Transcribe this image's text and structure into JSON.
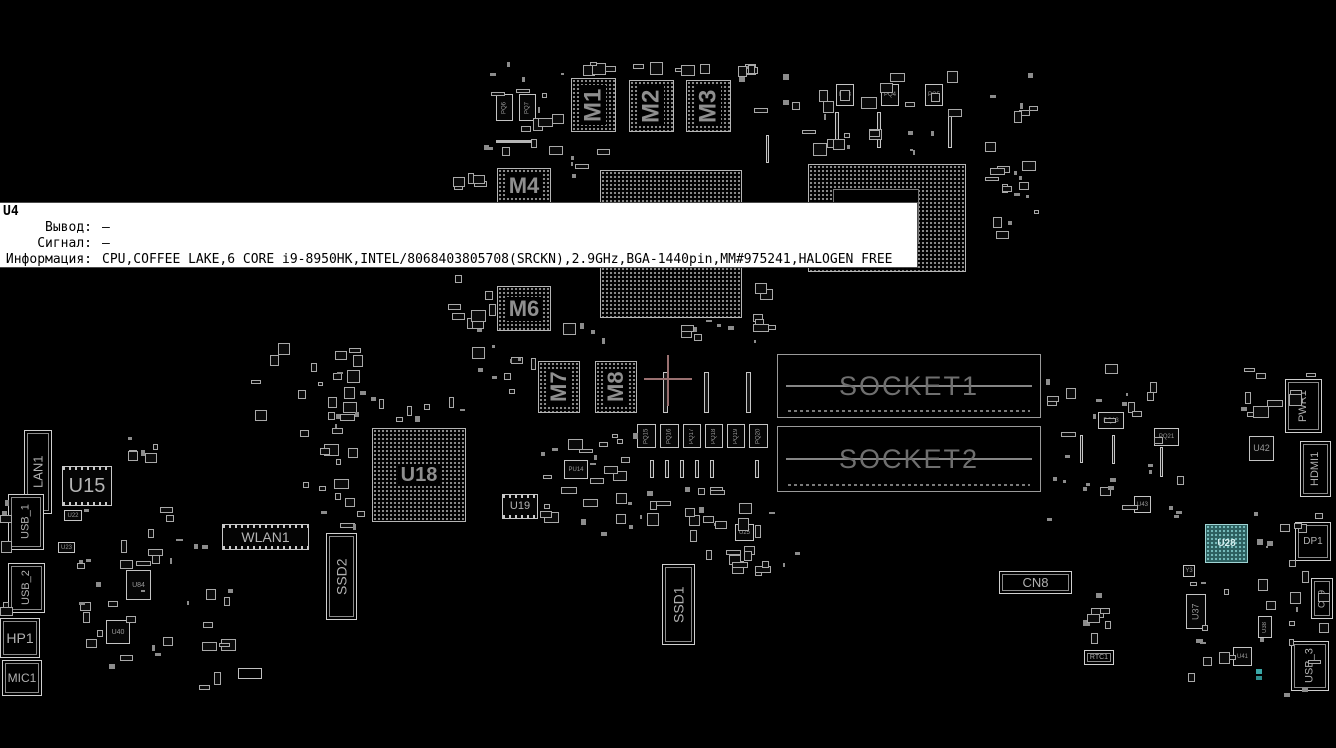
{
  "app": {
    "background": "#000000",
    "outline_color": "#c0c0c0",
    "label_color": "#9a9a9a"
  },
  "tooltip": {
    "ref": "U4",
    "fields": [
      {
        "label": "Вывод:",
        "value": "–"
      },
      {
        "label": "Сигнал:",
        "value": "–"
      },
      {
        "label": "Информация:",
        "value": "CPU,COFFEE LAKE,6 CORE i9-8950HK,INTEL/8068403805708(SRCKN),2.9GHz,BGA-1440pin,MM#975241,HALOGEN FREE"
      }
    ]
  },
  "crosshair": {
    "x": 668,
    "y": 379,
    "color": "#9a7070",
    "h_len": 48,
    "v_len": 51,
    "thickness": 2
  },
  "board": {
    "components": [
      {
        "name": "component-m1",
        "label": "M1",
        "type": "bga",
        "x": 571,
        "y": 78,
        "w": 45,
        "h": 54,
        "vert": true,
        "fs": 24
      },
      {
        "name": "component-m2",
        "label": "M2",
        "type": "bga",
        "x": 629,
        "y": 80,
        "w": 45,
        "h": 52,
        "vert": true,
        "fs": 24
      },
      {
        "name": "component-m3",
        "label": "M3",
        "type": "bga",
        "x": 686,
        "y": 80,
        "w": 45,
        "h": 52,
        "vert": true,
        "fs": 24
      },
      {
        "name": "component-m4",
        "label": "M4",
        "type": "bga",
        "x": 497,
        "y": 168,
        "w": 54,
        "h": 36,
        "vert": false,
        "fs": 22
      },
      {
        "name": "component-m6",
        "label": "M6",
        "type": "bga",
        "x": 497,
        "y": 286,
        "w": 54,
        "h": 45,
        "vert": false,
        "fs": 22
      },
      {
        "name": "component-m7",
        "label": "M7",
        "type": "bga",
        "x": 538,
        "y": 361,
        "w": 42,
        "h": 52,
        "vert": true,
        "fs": 22
      },
      {
        "name": "component-m8",
        "label": "M8",
        "type": "bga",
        "x": 595,
        "y": 361,
        "w": 42,
        "h": 52,
        "vert": true,
        "fs": 22
      },
      {
        "name": "component-u4-cpu",
        "label": "",
        "type": "bga",
        "x": 600,
        "y": 170,
        "w": 142,
        "h": 148,
        "vert": false,
        "fs": 0
      },
      {
        "name": "component-pch",
        "label": "",
        "type": "frame",
        "x": 808,
        "y": 164,
        "w": 158,
        "h": 108,
        "vert": false,
        "fs": 0
      },
      {
        "name": "component-socket1",
        "label": "SOCKET1",
        "type": "socket",
        "x": 777,
        "y": 354,
        "w": 264,
        "h": 64,
        "vert": false,
        "fs": 27
      },
      {
        "name": "component-socket2",
        "label": "SOCKET2",
        "type": "socket",
        "x": 777,
        "y": 426,
        "w": 264,
        "h": 66,
        "vert": false,
        "fs": 27
      },
      {
        "name": "component-u18",
        "label": "U18",
        "type": "bga",
        "x": 372,
        "y": 428,
        "w": 94,
        "h": 94,
        "vert": false,
        "fs": 20
      },
      {
        "name": "component-u15",
        "label": "U15",
        "type": "icpins",
        "x": 62,
        "y": 466,
        "w": 50,
        "h": 40,
        "vert": false,
        "fs": 20
      },
      {
        "name": "component-u19",
        "label": "U19",
        "type": "icpins",
        "x": 502,
        "y": 494,
        "w": 36,
        "h": 25,
        "vert": false,
        "fs": 11
      },
      {
        "name": "component-lan1",
        "label": "LAN1",
        "type": "conn",
        "x": 24,
        "y": 430,
        "w": 28,
        "h": 84,
        "vert": true,
        "fs": 13
      },
      {
        "name": "component-usb1",
        "label": "USB_1",
        "type": "conn",
        "x": 8,
        "y": 494,
        "w": 36,
        "h": 56,
        "vert": true,
        "fs": 11
      },
      {
        "name": "component-usb2",
        "label": "USB_2",
        "type": "conn",
        "x": 8,
        "y": 563,
        "w": 37,
        "h": 50,
        "vert": true,
        "fs": 11
      },
      {
        "name": "component-hp1",
        "label": "HP1",
        "type": "conn",
        "x": 0,
        "y": 618,
        "w": 40,
        "h": 40,
        "vert": false,
        "fs": 14
      },
      {
        "name": "component-mic1",
        "label": "MIC1",
        "type": "conn",
        "x": 2,
        "y": 660,
        "w": 40,
        "h": 36,
        "vert": false,
        "fs": 12
      },
      {
        "name": "component-wlan1",
        "label": "WLAN1",
        "type": "icpins",
        "x": 222,
        "y": 524,
        "w": 87,
        "h": 26,
        "vert": false,
        "fs": 14
      },
      {
        "name": "component-ssd2",
        "label": "SSD2",
        "type": "conn",
        "x": 326,
        "y": 533,
        "w": 31,
        "h": 87,
        "vert": true,
        "fs": 14
      },
      {
        "name": "component-ssd1",
        "label": "SSD1",
        "type": "conn",
        "x": 662,
        "y": 564,
        "w": 33,
        "h": 81,
        "vert": true,
        "fs": 14
      },
      {
        "name": "component-cn8",
        "label": "CN8",
        "type": "conn",
        "x": 999,
        "y": 571,
        "w": 73,
        "h": 23,
        "vert": false,
        "fs": 13
      },
      {
        "name": "component-pwr1",
        "label": "PWR1",
        "type": "conn",
        "x": 1285,
        "y": 379,
        "w": 37,
        "h": 54,
        "vert": true,
        "fs": 11
      },
      {
        "name": "component-u42",
        "label": "U42",
        "type": "ic",
        "x": 1249,
        "y": 436,
        "w": 25,
        "h": 25,
        "vert": false,
        "fs": 9
      },
      {
        "name": "component-hdmi1",
        "label": "HDMI1",
        "type": "conn",
        "x": 1300,
        "y": 441,
        "w": 31,
        "h": 56,
        "vert": true,
        "fs": 11
      },
      {
        "name": "component-u28",
        "label": "U28",
        "type": "bgateal",
        "x": 1205,
        "y": 524,
        "w": 43,
        "h": 39,
        "vert": false,
        "fs": 10
      },
      {
        "name": "component-dp1",
        "label": "DP1",
        "type": "conn",
        "x": 1295,
        "y": 522,
        "w": 36,
        "h": 39,
        "vert": false,
        "fs": 10
      },
      {
        "name": "component-cn9",
        "label": "CN9",
        "type": "conn",
        "x": 1311,
        "y": 578,
        "w": 22,
        "h": 41,
        "vert": true,
        "fs": 9
      },
      {
        "name": "component-u37",
        "label": "U37",
        "type": "ic",
        "x": 1186,
        "y": 594,
        "w": 20,
        "h": 35,
        "vert": true,
        "fs": 9
      },
      {
        "name": "component-usb3",
        "label": "USB_3",
        "type": "conn",
        "x": 1291,
        "y": 641,
        "w": 38,
        "h": 50,
        "vert": true,
        "fs": 11
      },
      {
        "name": "component-rtc1",
        "label": "RTC1",
        "type": "conn",
        "x": 1084,
        "y": 650,
        "w": 30,
        "h": 15,
        "vert": false,
        "fs": 7
      },
      {
        "name": "component-pq6",
        "label": "PQ6",
        "type": "ic",
        "x": 496,
        "y": 94,
        "w": 17,
        "h": 27,
        "vert": true,
        "fs": 6
      },
      {
        "name": "component-pq7",
        "label": "PQ7",
        "type": "ic",
        "x": 519,
        "y": 94,
        "w": 17,
        "h": 27,
        "vert": true,
        "fs": 6
      },
      {
        "name": "component-pq3",
        "label": "PQ3",
        "type": "ic",
        "x": 836,
        "y": 84,
        "w": 18,
        "h": 22,
        "vert": false,
        "fs": 6
      },
      {
        "name": "component-pq4",
        "label": "PQ4",
        "type": "ic",
        "x": 881,
        "y": 84,
        "w": 18,
        "h": 22,
        "vert": false,
        "fs": 6
      },
      {
        "name": "component-pq5",
        "label": "PQ5",
        "type": "ic",
        "x": 925,
        "y": 84,
        "w": 18,
        "h": 22,
        "vert": false,
        "fs": 6
      },
      {
        "name": "component-pq15",
        "label": "PQ15",
        "type": "ic",
        "x": 637,
        "y": 424,
        "w": 19,
        "h": 24,
        "vert": true,
        "fs": 6
      },
      {
        "name": "component-pq16",
        "label": "PQ16",
        "type": "ic",
        "x": 660,
        "y": 424,
        "w": 19,
        "h": 24,
        "vert": true,
        "fs": 6
      },
      {
        "name": "component-pq17",
        "label": "PQ17",
        "type": "ic",
        "x": 683,
        "y": 424,
        "w": 18,
        "h": 24,
        "vert": true,
        "fs": 6
      },
      {
        "name": "component-pq18",
        "label": "PQ18",
        "type": "ic",
        "x": 705,
        "y": 424,
        "w": 18,
        "h": 24,
        "vert": true,
        "fs": 6
      },
      {
        "name": "component-pq19",
        "label": "PQ19",
        "type": "ic",
        "x": 727,
        "y": 424,
        "w": 18,
        "h": 24,
        "vert": true,
        "fs": 6
      },
      {
        "name": "component-pq20",
        "label": "PQ20",
        "type": "ic",
        "x": 749,
        "y": 424,
        "w": 19,
        "h": 24,
        "vert": true,
        "fs": 6
      },
      {
        "name": "component-pq13",
        "label": "PQ13",
        "type": "ic",
        "x": 1098,
        "y": 412,
        "w": 26,
        "h": 17,
        "vert": false,
        "fs": 6
      },
      {
        "name": "component-pq21",
        "label": "PQ21",
        "type": "ic",
        "x": 1154,
        "y": 428,
        "w": 25,
        "h": 18,
        "vert": false,
        "fs": 6
      },
      {
        "name": "component-u43",
        "label": "U43",
        "type": "ic",
        "x": 1134,
        "y": 496,
        "w": 17,
        "h": 17,
        "vert": false,
        "fs": 6
      },
      {
        "name": "component-pu14",
        "label": "PU14",
        "type": "ic",
        "x": 564,
        "y": 460,
        "w": 24,
        "h": 19,
        "vert": false,
        "fs": 6
      },
      {
        "name": "component-u25",
        "label": "U25",
        "type": "ic",
        "x": 735,
        "y": 524,
        "w": 19,
        "h": 17,
        "vert": false,
        "fs": 6
      },
      {
        "name": "component-u22",
        "label": "U22",
        "type": "ic",
        "x": 64,
        "y": 510,
        "w": 18,
        "h": 11,
        "vert": false,
        "fs": 6
      },
      {
        "name": "component-u23",
        "label": "U23",
        "type": "ic",
        "x": 58,
        "y": 542,
        "w": 17,
        "h": 11,
        "vert": false,
        "fs": 6
      },
      {
        "name": "component-u84",
        "label": "U84",
        "type": "ic",
        "x": 126,
        "y": 570,
        "w": 25,
        "h": 30,
        "vert": false,
        "fs": 7
      },
      {
        "name": "component-u40",
        "label": "U40",
        "type": "ic",
        "x": 106,
        "y": 620,
        "w": 24,
        "h": 24,
        "vert": false,
        "fs": 7
      },
      {
        "name": "component-u41",
        "label": "U41",
        "type": "ic",
        "x": 1233,
        "y": 647,
        "w": 19,
        "h": 19,
        "vert": false,
        "fs": 6
      },
      {
        "name": "component-u38",
        "label": "U38",
        "type": "ic",
        "x": 1258,
        "y": 616,
        "w": 14,
        "h": 22,
        "vert": true,
        "fs": 6
      },
      {
        "name": "component-y3",
        "label": "Y3",
        "type": "ic",
        "x": 1183,
        "y": 565,
        "w": 12,
        "h": 12,
        "vert": false,
        "fs": 6
      }
    ],
    "slots": [
      [
        663,
        372,
        5,
        41
      ],
      [
        704,
        372,
        5,
        41
      ],
      [
        746,
        372,
        5,
        41
      ],
      [
        835,
        112,
        4,
        36
      ],
      [
        877,
        112,
        4,
        36
      ],
      [
        948,
        112,
        4,
        36
      ],
      [
        766,
        135,
        3,
        28
      ],
      [
        650,
        460,
        4,
        18
      ],
      [
        665,
        460,
        4,
        18
      ],
      [
        680,
        460,
        4,
        18
      ],
      [
        695,
        460,
        4,
        18
      ],
      [
        710,
        460,
        4,
        18
      ],
      [
        755,
        460,
        4,
        18
      ],
      [
        1080,
        435,
        3,
        28
      ],
      [
        1112,
        435,
        3,
        29
      ],
      [
        1160,
        447,
        3,
        30
      ]
    ],
    "clusters": [
      [
        478,
        58,
        88,
        100,
        16
      ],
      [
        556,
        62,
        205,
        14,
        12
      ],
      [
        772,
        58,
        195,
        100,
        26
      ],
      [
        975,
        62,
        68,
        165,
        14
      ],
      [
        450,
        168,
        45,
        32,
        5
      ],
      [
        448,
        272,
        48,
        72,
        9
      ],
      [
        560,
        320,
        210,
        26,
        12
      ],
      [
        246,
        342,
        118,
        98,
        22
      ],
      [
        298,
        440,
        70,
        92,
        14
      ],
      [
        540,
        425,
        98,
        112,
        26
      ],
      [
        640,
        482,
        138,
        60,
        20
      ],
      [
        48,
        505,
        188,
        188,
        40
      ],
      [
        0,
        470,
        10,
        148,
        6
      ],
      [
        1045,
        358,
        148,
        172,
        32
      ],
      [
        1183,
        560,
        148,
        138,
        24
      ],
      [
        700,
        546,
        118,
        32,
        12
      ],
      [
        1078,
        560,
        40,
        98,
        7
      ],
      [
        985,
        163,
        58,
        78,
        8
      ],
      [
        118,
        424,
        40,
        44,
        6
      ],
      [
        350,
        390,
        118,
        32,
        10
      ],
      [
        465,
        345,
        78,
        58,
        10
      ],
      [
        752,
        282,
        26,
        50,
        6
      ],
      [
        1240,
        365,
        90,
        58,
        10
      ],
      [
        1253,
        495,
        75,
        58,
        8
      ],
      [
        556,
        138,
        60,
        40,
        6
      ],
      [
        735,
        62,
        35,
        60,
        5
      ]
    ],
    "extras": [
      {
        "x": 1256,
        "y": 669,
        "w": 6,
        "h": 5,
        "color": "#3aa8a8",
        "border": false
      },
      {
        "x": 1256,
        "y": 676,
        "w": 6,
        "h": 4,
        "color": "#2f8f8f",
        "border": false
      },
      {
        "x": 496,
        "y": 140,
        "w": 36,
        "h": 3,
        "color": "#b5b5b5",
        "border": false
      },
      {
        "x": 238,
        "y": 668,
        "w": 24,
        "h": 11,
        "color": "#c0c0c0",
        "border": true
      }
    ]
  }
}
